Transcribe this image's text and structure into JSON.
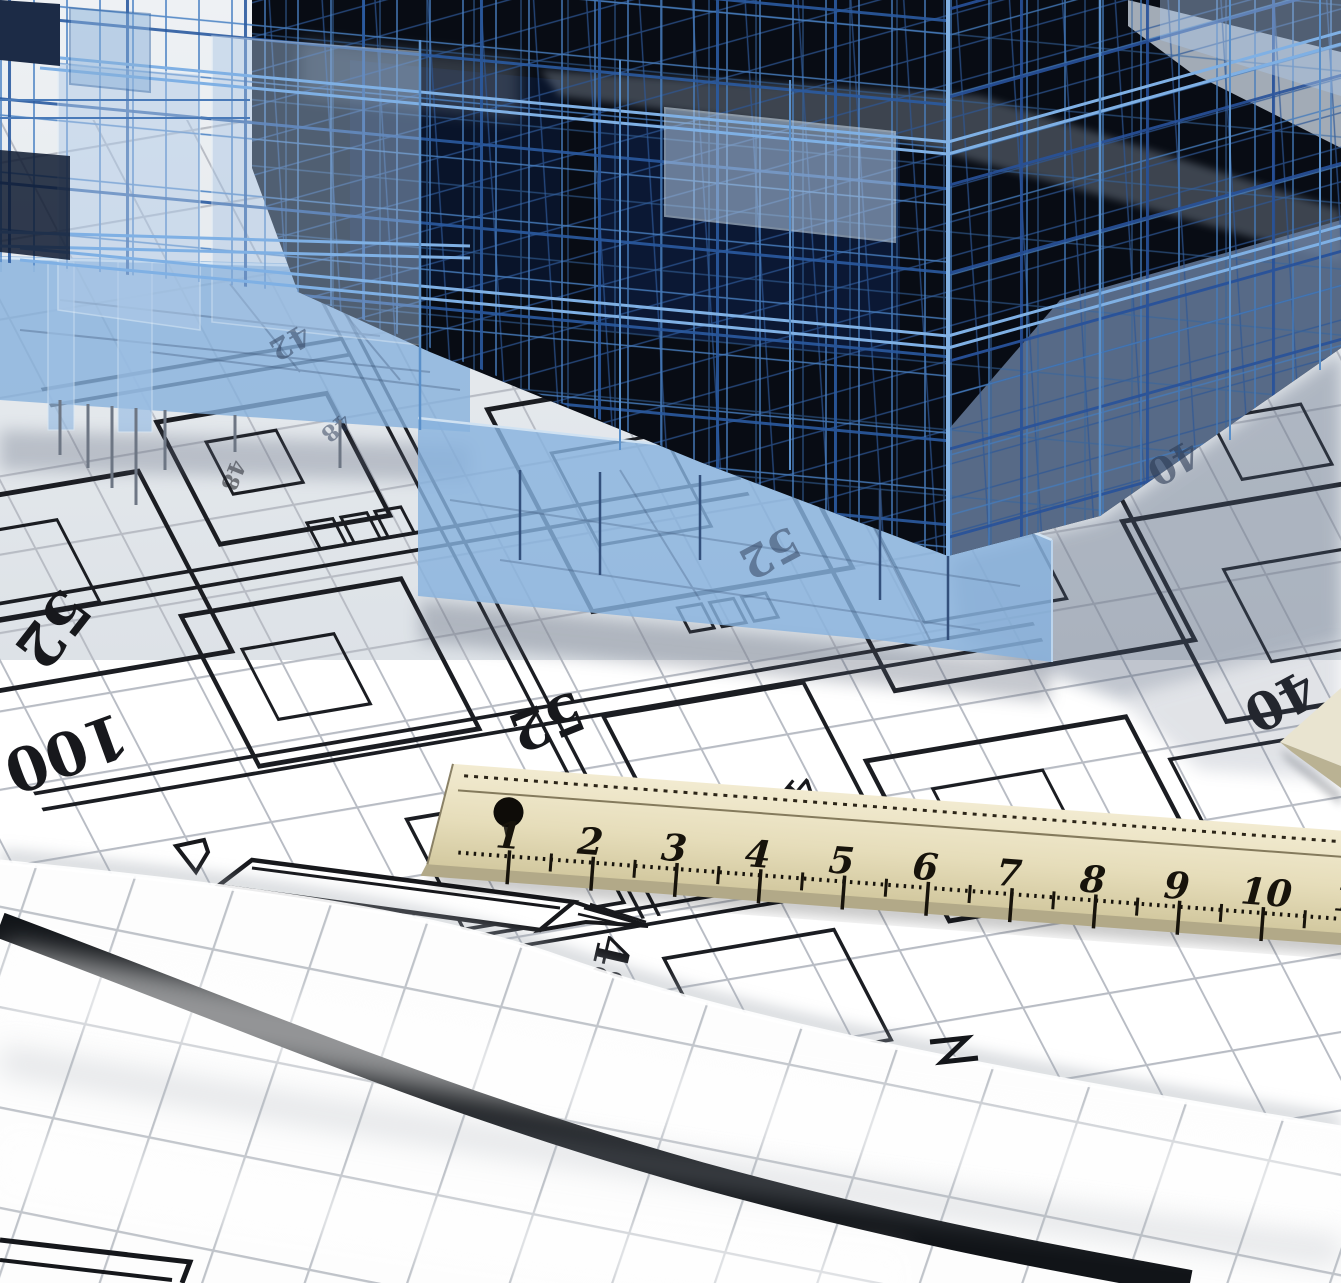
{
  "blueprint": {
    "numbers": [
      "52",
      "100",
      "52",
      "48",
      "40",
      "5",
      "48",
      "48"
    ],
    "glass_numbers": [
      "42",
      "48",
      "52",
      "40"
    ],
    "paper_color": "#ffffff",
    "grid_color": "#b8bcc4",
    "line_color": "#1b1d22"
  },
  "ruler": {
    "numbers": [
      "1",
      "2",
      "3",
      "4",
      "5",
      "6",
      "7",
      "8",
      "9",
      "10",
      "11"
    ],
    "face_color": "#e6ddba",
    "marking_color": "#17130b"
  },
  "building": {
    "wire_color": "#4a82c4",
    "wire_color_dark": "#27519a",
    "glass_color": "#a8c8e8",
    "interior_color": "#080c14"
  },
  "roll": {
    "grid_color": "#bfc3c9",
    "heavy_line_color": "#111418"
  }
}
